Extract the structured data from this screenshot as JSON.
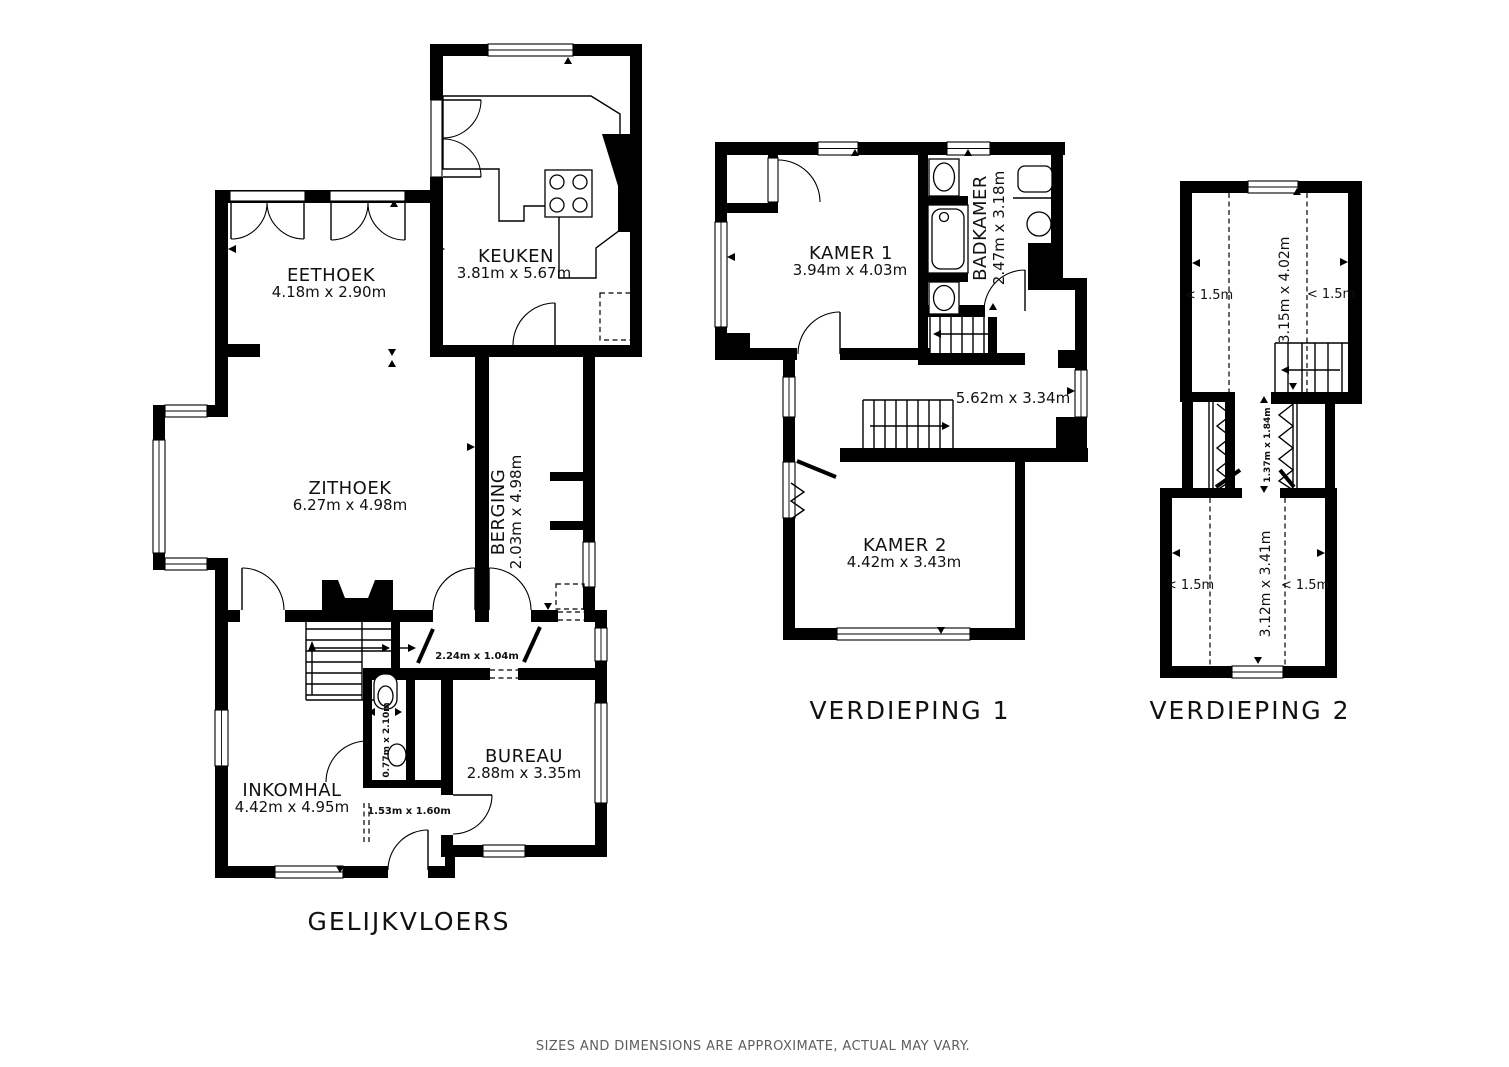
{
  "disclaimer": "SIZES AND DIMENSIONS ARE APPROXIMATE, ACTUAL MAY VARY.",
  "floors": {
    "ground": {
      "label": "GELIJKVLOERS",
      "rooms": {
        "eethoek": {
          "name": "EETHOEK",
          "dims": "4.18m x 2.90m"
        },
        "keuken": {
          "name": "KEUKEN",
          "dims": "3.81m x 5.67m"
        },
        "zithoek": {
          "name": "ZITHOEK",
          "dims": "6.27m x 4.98m"
        },
        "berging": {
          "name": "BERGING",
          "dims": "2.03m x 4.98m"
        },
        "inkomhal": {
          "name": "INKOMHAL",
          "dims": "4.42m x 4.95m"
        },
        "bureau": {
          "name": "BUREAU",
          "dims": "2.88m x 3.35m"
        },
        "gang": {
          "dims": "2.24m x 1.04m"
        },
        "toilet": {
          "dims": "0.77m x 2.10m"
        },
        "hal": {
          "dims": "1.53m x 1.60m"
        }
      }
    },
    "first": {
      "label": "VERDIEPING 1",
      "rooms": {
        "kamer1": {
          "name": "KAMER 1",
          "dims": "3.94m x 4.03m"
        },
        "badkamer": {
          "name": "BADKAMER",
          "dims": "2.47m x 3.18m"
        },
        "overloop": {
          "dims": "5.62m x 3.34m"
        },
        "kamer2": {
          "name": "KAMER 2",
          "dims": "4.42m x 3.43m"
        }
      }
    },
    "second": {
      "label": "VERDIEPING 2",
      "rooms": {
        "boven": {
          "dims": "3.15m x 4.02m"
        },
        "gang": {
          "dims": "1.37m x 1.84m"
        },
        "onder": {
          "dims": "3.12m x 3.41m"
        }
      },
      "knee": {
        "tl": "< 1.5m",
        "tr": "< 1.5m",
        "bl": "< 1.5m",
        "br": "< 1.5m"
      }
    }
  }
}
